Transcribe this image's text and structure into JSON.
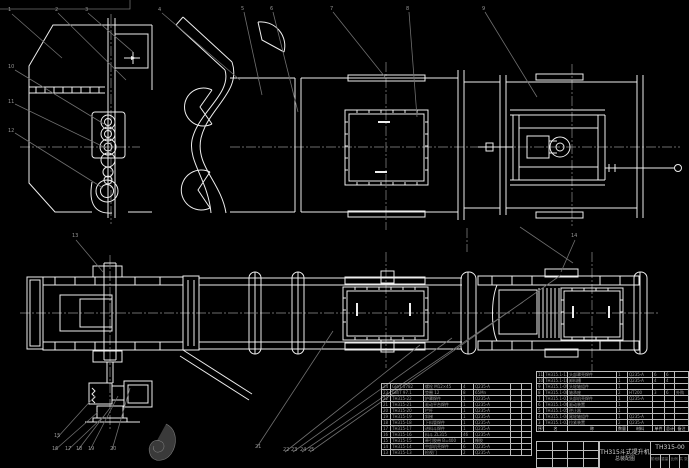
{
  "title_block": {
    "product": "TH315斗式提升机",
    "sheet": "总装配图",
    "drawing_no": "TH315-00",
    "footer_cells": [
      "阶段标记",
      "重量",
      "比例",
      "共 张 第 张"
    ]
  },
  "bom_right": {
    "header": [
      "序号",
      "名",
      "称",
      "数量",
      "材料",
      "单件",
      "总计",
      "备注"
    ],
    "rows": [
      [
        "11",
        "TH315.1-11",
        "头部罩壳焊件",
        "1",
        "Q235-A",
        "6",
        "6",
        ""
      ],
      [
        "10",
        "TH315.1-10",
        "卸料槽",
        "1",
        "Q235-A",
        "4",
        "4",
        ""
      ],
      [
        "9",
        "TH315.1-09",
        "头轮轴组件",
        "1",
        "",
        "",
        "",
        ""
      ],
      [
        "8",
        "TH315.1-08",
        "轴承座",
        "2",
        "HT200",
        "3",
        "6",
        "外购"
      ],
      [
        "7",
        "TH315.1-07",
        "头部机壳焊件",
        "1",
        "Q235-A",
        "",
        "",
        ""
      ],
      [
        "6",
        "TH315.1-06",
        "驱动装置",
        "1",
        "",
        "",
        "",
        ""
      ],
      [
        "5",
        "TH315.1-05",
        "逆止器",
        "1",
        "",
        "",
        "",
        ""
      ],
      [
        "4",
        "TH315.1-04",
        "尾轮轴组件",
        "1",
        "Q235-A",
        "",
        "",
        ""
      ],
      [
        "3",
        "TH315.1-03",
        "拉紧装置",
        "2",
        "Q235-A",
        "",
        "",
        ""
      ]
    ]
  },
  "bom_left": {
    "rows": [
      [
        "24",
        "GB/T 5782",
        "螺栓 M12×45",
        "4",
        "Q235-A",
        "",
        ""
      ],
      [
        "23",
        "GB/T 97.1",
        "垫圈 12",
        "8",
        "65Mn",
        "",
        ""
      ],
      [
        "22",
        "TH315-22",
        "护罩焊件",
        "1",
        "Q235-A",
        "",
        ""
      ],
      [
        "21",
        "TH315-21",
        "驱动平台焊件",
        "1",
        "Q235-A",
        "",
        ""
      ],
      [
        "20",
        "TH315-20",
        "栏杆",
        "1",
        "Q235-A",
        "",
        ""
      ],
      [
        "19",
        "TH315-19",
        "斜梯",
        "1",
        "Q235-A",
        "",
        ""
      ],
      [
        "18",
        "TH315-18",
        "下料管焊件",
        "1",
        "Q235-A",
        "",
        ""
      ],
      [
        "17",
        "TH315-17",
        "进料斗焊件",
        "1",
        "Q235-A",
        "",
        ""
      ],
      [
        "16",
        "TH315-16",
        "料斗 ZL315",
        "46",
        "Q235-A",
        "",
        ""
      ],
      [
        "15",
        "TH315-15",
        "牵引胶带 B=400",
        "1",
        "橡胶",
        "",
        ""
      ],
      [
        "14",
        "TH315-14",
        "中部机壳焊件",
        "6",
        "Q235-A",
        "",
        ""
      ],
      [
        "13",
        "TH315-13",
        "检视门",
        "2",
        "Q235-A",
        "",
        ""
      ]
    ]
  },
  "callouts": [
    "1",
    "2",
    "3",
    "4",
    "5",
    "6",
    "7",
    "8",
    "9",
    "10",
    "11",
    "12",
    "13",
    "14",
    "15",
    "16",
    "17",
    "18",
    "19",
    "20",
    "21",
    "22",
    "23",
    "24",
    "25"
  ]
}
